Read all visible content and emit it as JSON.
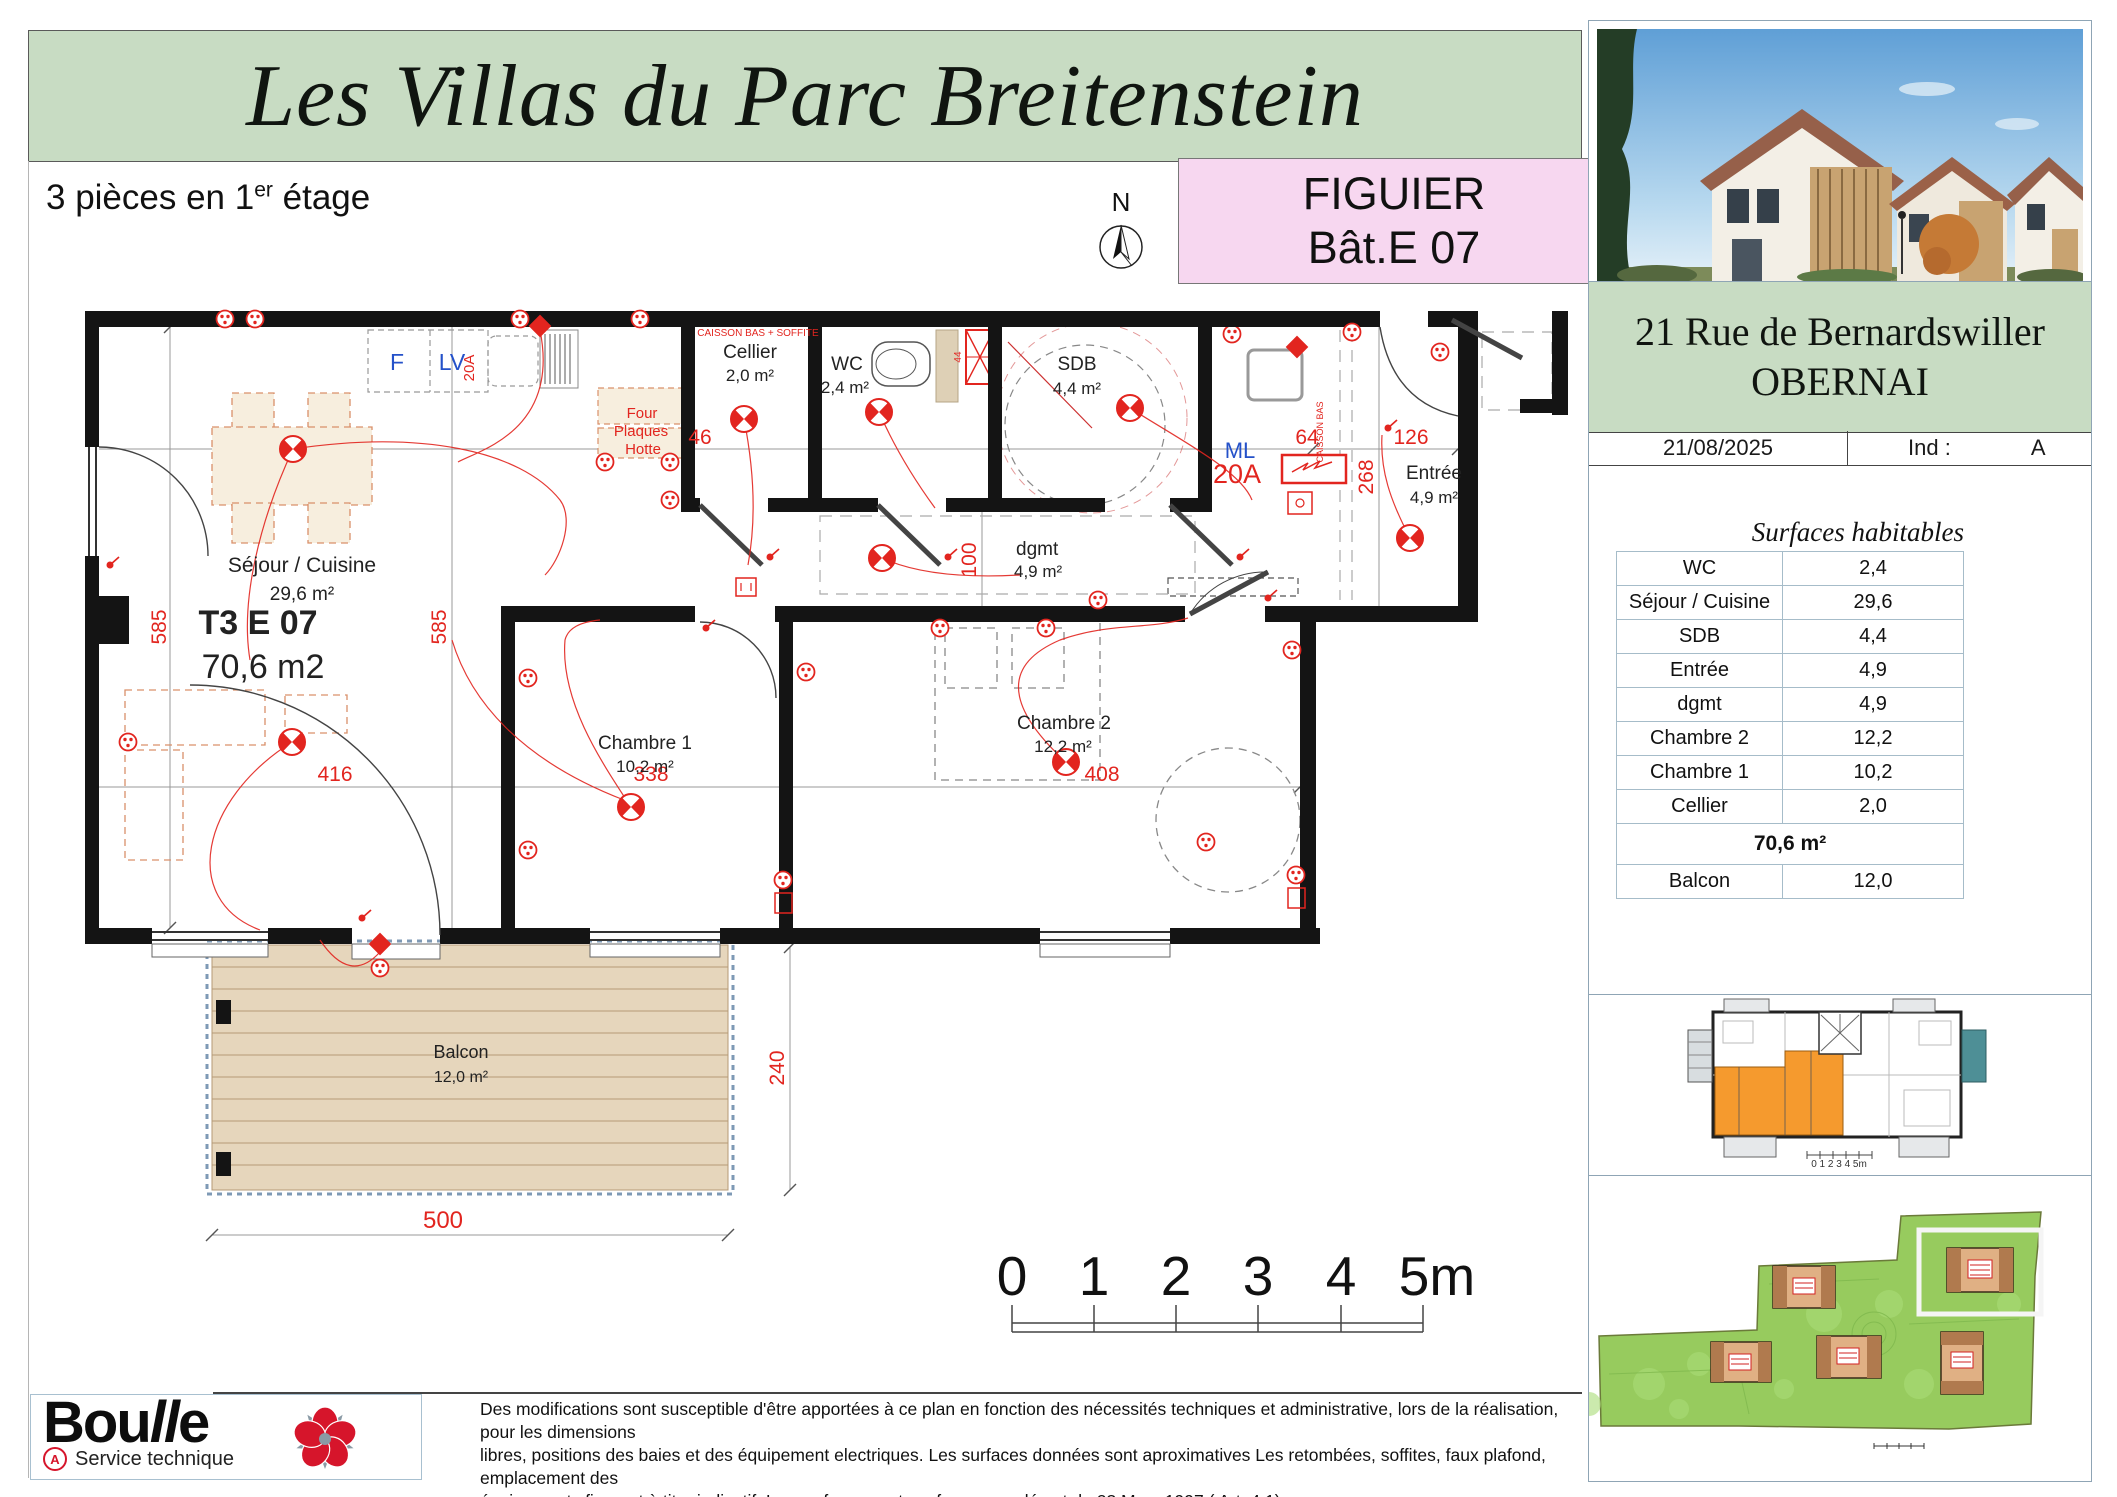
{
  "header": {
    "title": "Les Villas du Parc Breitenstein",
    "subtitle": {
      "prefix": "3 pièces en 1",
      "sup": "er",
      "suffix": " étage"
    },
    "compass_n": "N"
  },
  "unit_badge": {
    "name": "FIGUIER",
    "building": "Bât.E 07"
  },
  "sidebar": {
    "address": {
      "line1": "21 Rue de Bernardswiller",
      "line2": "OBERNAI"
    },
    "date": "21/08/2025",
    "ind_label": "Ind :",
    "ind_value": "A",
    "surfaces": {
      "title": "Surfaces habitables",
      "rows": [
        {
          "label": "WC",
          "value": "2,4"
        },
        {
          "label": "Séjour / Cuisine",
          "value": "29,6"
        },
        {
          "label": "SDB",
          "value": "4,4"
        },
        {
          "label": "Entrée",
          "value": "4,9"
        },
        {
          "label": "dgmt",
          "value": "4,9"
        },
        {
          "label": "Chambre 2",
          "value": "12,2"
        },
        {
          "label": "Chambre 1",
          "value": "10,2"
        },
        {
          "label": "Cellier",
          "value": "2,0"
        }
      ],
      "total": "70,6 m²",
      "balcon": {
        "label": "Balcon",
        "value": "12,0"
      }
    },
    "keyplan_scale": "0  1  2  3  4  5m"
  },
  "plan": {
    "unit": {
      "code": "T3 E 07",
      "area": "70,6 m2"
    },
    "rooms": {
      "sejour": {
        "name": "Séjour / Cuisine",
        "area": "29,6 m²"
      },
      "cellier": {
        "name": "Cellier",
        "area": "2,0 m²"
      },
      "wc": {
        "name": "WC",
        "area": "2,4 m²"
      },
      "sdb": {
        "name": "SDB",
        "area": "4,4 m²"
      },
      "entree": {
        "name": "Entrée",
        "area": "4,9 m²"
      },
      "dgmt": {
        "name": "dgmt",
        "area": "4,9 m²"
      },
      "chambre1": {
        "name": "Chambre 1",
        "area": "10,2 m²"
      },
      "chambre2": {
        "name": "Chambre 2",
        "area": "12,2 m²"
      },
      "balcon": {
        "name": "Balcon",
        "area": "12,0 m²"
      }
    },
    "labels": {
      "caisson": "CAISSON BAS + SOFFITE",
      "caisson_vertical": "CAISSON BAS",
      "four": "Four",
      "plaques": "Plaques",
      "hotte": "Hotte",
      "frigo": "F",
      "lave_vaisselle": "LV",
      "machine_laver": "ML",
      "amp_cuisine": "20A",
      "amp_ml": "20A",
      "shaft": "44"
    },
    "dimensions": {
      "d585_left": "585",
      "d585_mid": "585",
      "d416": "416",
      "d338": "338",
      "d408": "408",
      "d100": "100",
      "d46": "46",
      "d64": "64",
      "d126": "126",
      "d268": "268",
      "d500": "500",
      "d240": "240"
    }
  },
  "scalebar": {
    "ticks": [
      "0",
      "1",
      "2",
      "3",
      "4",
      "5m"
    ]
  },
  "footer": {
    "brand": {
      "part1": "Bou",
      "part2": "ll",
      "part3": "e"
    },
    "brand_mark": "A",
    "brand_sub": "Service technique",
    "disclaimer": [
      "Des modifications sont susceptible d'être apportées à ce plan en fonction des nécessités techniques et administrative, lors de la réalisation, pour les dimensions",
      "libres, positions des baies et des équipement electriques. Les surfaces données sont aproximatives Les retombées, soffites, faux plafond, emplacement des",
      "équipements figurent à titre indicatif. Les surfaces sont conformes au décret du 23 Mars 1997 ( Art. 4.1)"
    ]
  },
  "colors": {
    "banner_green": "#c8dcc3",
    "badge_pink": "#f7d7f0",
    "accent_red": "#e2251f",
    "accent_blue": "#2451c9",
    "wall_black": "#141414",
    "deck_tan": "#e6d6bc",
    "site_green": "#97cb5e",
    "unit_orange": "#f59a2e"
  }
}
